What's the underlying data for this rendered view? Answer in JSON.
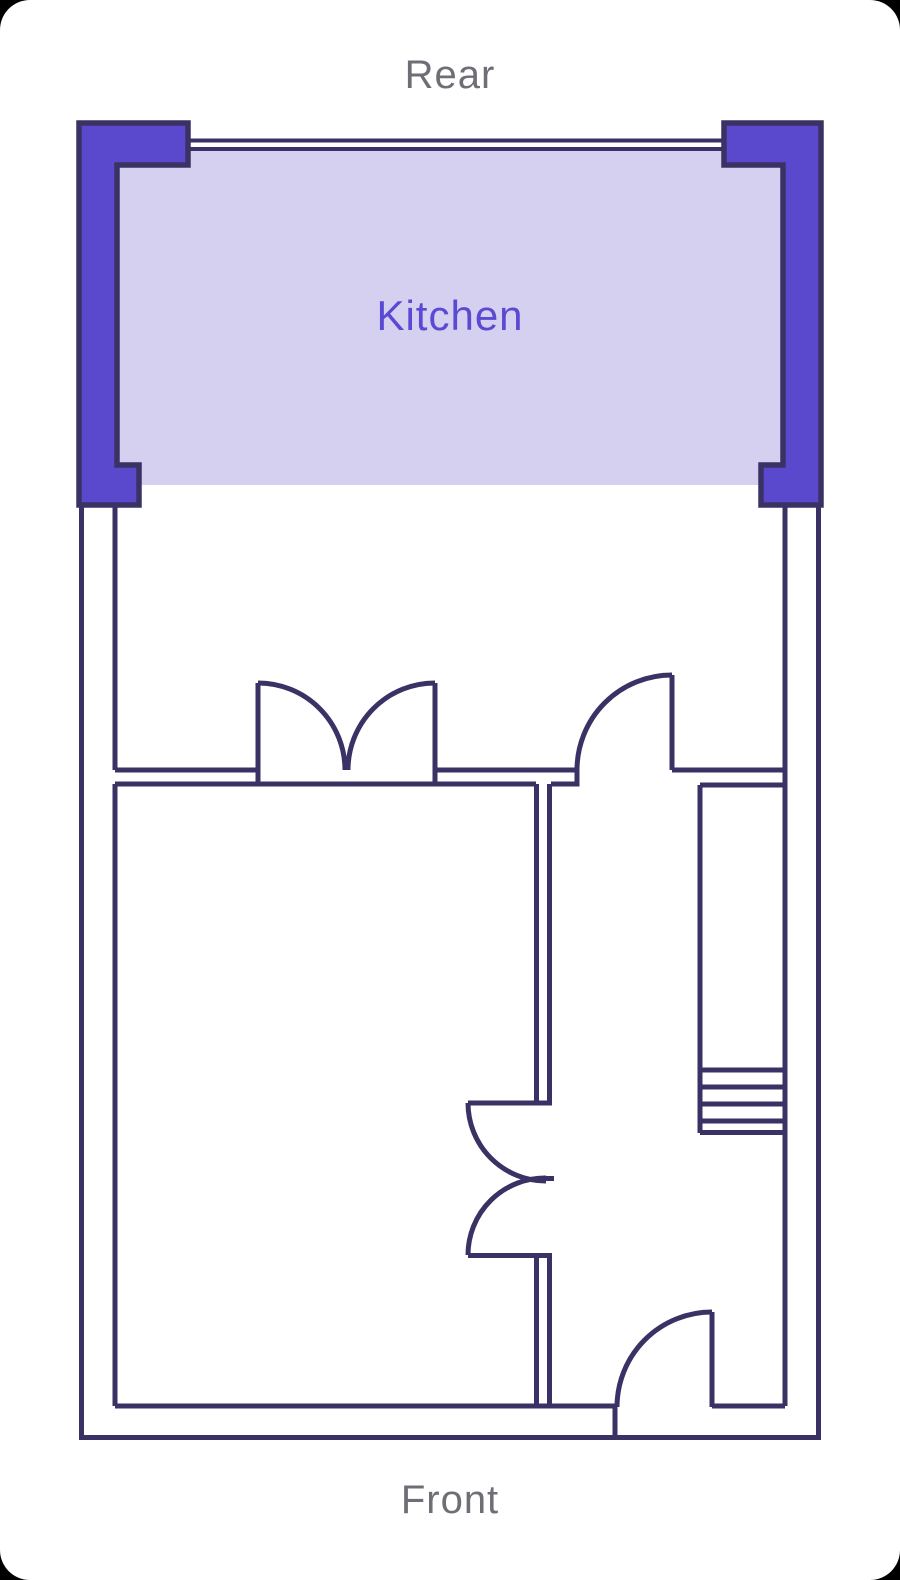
{
  "labels": {
    "rear": "Rear",
    "front": "Front"
  },
  "rooms": {
    "kitchen": {
      "label": "Kitchen"
    }
  },
  "colors": {
    "card_bg": "#ffffff",
    "backdrop": "#000000",
    "wall_outline": "#3a3264",
    "wall_fill": "#5a49cc",
    "kitchen_fill": "#d5cff0",
    "room_label": "#5a49d2",
    "label_gray": "#6e6e77"
  }
}
